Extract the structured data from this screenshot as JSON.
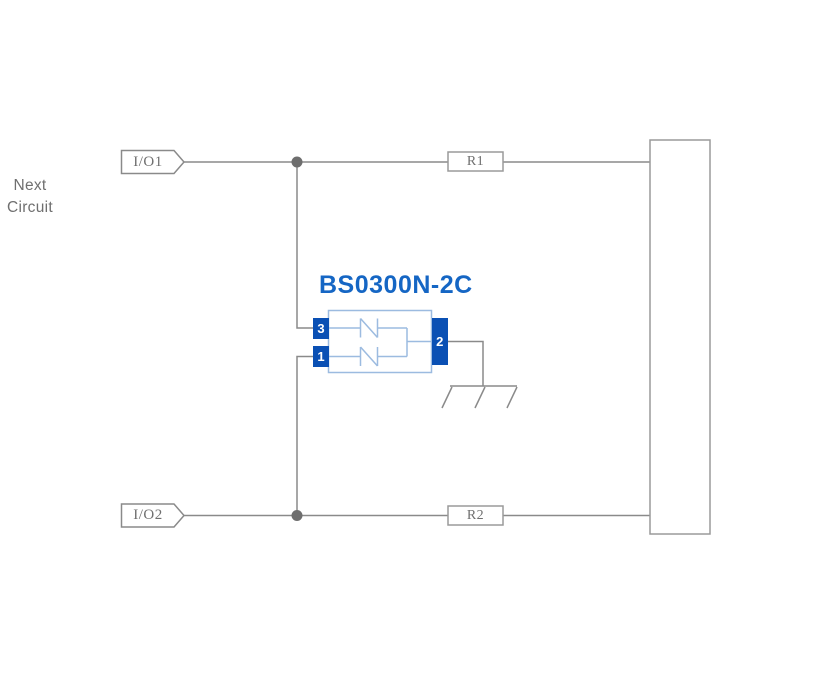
{
  "diagram": {
    "title": "BS0300N-2C",
    "io_ports": [
      {
        "label": "I/O1"
      },
      {
        "label": "I/O2"
      }
    ],
    "resistors": [
      {
        "label": "R1"
      },
      {
        "label": "R2"
      }
    ],
    "next_circuit": {
      "line1": "Next",
      "line2": "Circuit"
    },
    "component": {
      "name": "BS0300N-2C",
      "pins": {
        "top_left": "3",
        "bottom_left": "1",
        "common": "2"
      }
    },
    "icons": [
      {
        "name": "ground-icon",
        "meaning": "chassis ground symbol"
      },
      {
        "name": "junction-dot",
        "meaning": "wire junction point"
      },
      {
        "name": "tvs-diode-icon",
        "meaning": "ESD suppression diode element"
      }
    ],
    "colors": {
      "wire": "#8a8a8a",
      "box_border": "#9a9a9a",
      "text_gray": "#6f6f6f",
      "junction": "#6e6e6e",
      "component_outline": "#9cbbe0",
      "pin_fill": "#0a50b4",
      "pin_text": "#ffffff",
      "title_blue": "#1566c4"
    }
  }
}
